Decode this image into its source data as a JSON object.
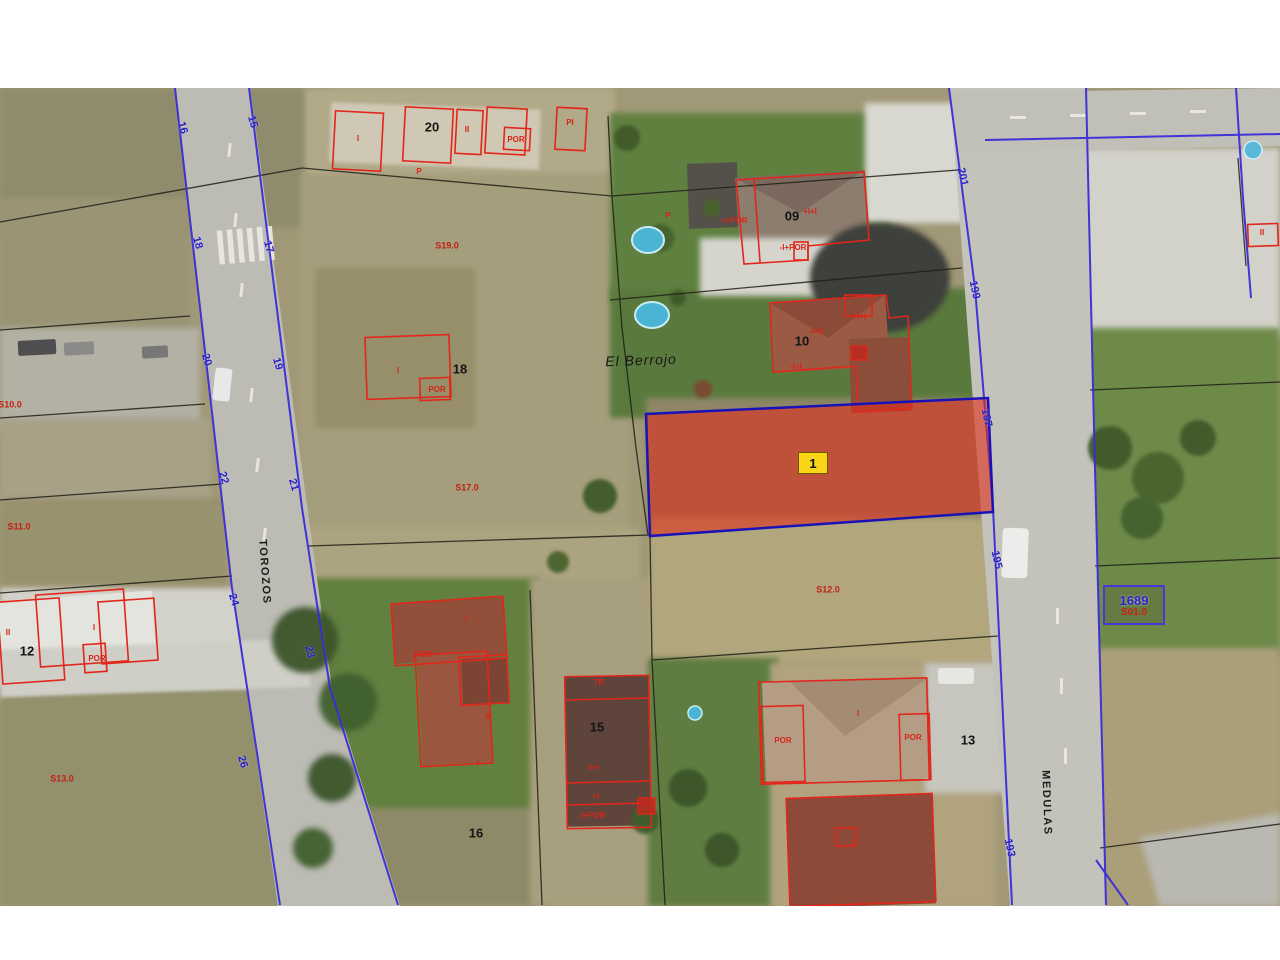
{
  "map": {
    "place_name": "El Berrojo",
    "highlight": {
      "label": "1"
    },
    "ref_box": {
      "id": "1689",
      "code": "S01.0"
    },
    "street_names": [
      "TOROZOS",
      "MEDULAS"
    ],
    "colors": {
      "building_outline_red": "#e2261b",
      "road_boundary_blue": "#3a2cd8",
      "parcel_boundary_black": "#1f1f18",
      "highlight_fill": "#e02e1c",
      "highlight_border": "#1812b8",
      "highlight_tag_yellow": "#f8d517",
      "street_number_blue": "#2a22c8",
      "ref_box_blue": "#4b36d8"
    },
    "labels": [
      {
        "t": "16",
        "x": 182,
        "y": 40,
        "r": 74,
        "cls": "nb"
      },
      {
        "t": "15",
        "x": 252,
        "y": 34,
        "r": 74,
        "cls": "nb"
      },
      {
        "t": "18",
        "x": 197,
        "y": 155,
        "r": 74,
        "cls": "nb"
      },
      {
        "t": "17",
        "x": 268,
        "y": 159,
        "r": 74,
        "cls": "nb"
      },
      {
        "t": "20",
        "x": 206,
        "y": 272,
        "r": 74,
        "cls": "nb"
      },
      {
        "t": "19",
        "x": 277,
        "y": 276,
        "r": 74,
        "cls": "nb"
      },
      {
        "t": "22",
        "x": 223,
        "y": 390,
        "r": 74,
        "cls": "nb"
      },
      {
        "t": "21",
        "x": 293,
        "y": 397,
        "r": 74,
        "cls": "nb"
      },
      {
        "t": "24",
        "x": 233,
        "y": 512,
        "r": 74,
        "cls": "nb"
      },
      {
        "t": "23",
        "x": 309,
        "y": 564,
        "r": 74,
        "cls": "nb"
      },
      {
        "t": "26",
        "x": 242,
        "y": 674,
        "r": 74,
        "cls": "nb"
      },
      {
        "t": "201",
        "x": 962,
        "y": 89,
        "r": 78,
        "cls": "nb"
      },
      {
        "t": "199",
        "x": 974,
        "y": 202,
        "r": 78,
        "cls": "nb"
      },
      {
        "t": "197",
        "x": 986,
        "y": 330,
        "r": 78,
        "cls": "nb"
      },
      {
        "t": "195",
        "x": 996,
        "y": 472,
        "r": 78,
        "cls": "nb"
      },
      {
        "t": "193",
        "x": 1009,
        "y": 760,
        "r": 78,
        "cls": "nb"
      },
      {
        "t": "20",
        "x": 432,
        "y": 39,
        "r": 0,
        "cls": "npk"
      },
      {
        "t": "09",
        "x": 792,
        "y": 128,
        "r": 0,
        "cls": "npk"
      },
      {
        "t": "10",
        "x": 802,
        "y": 253,
        "r": 0,
        "cls": "npk"
      },
      {
        "t": "18",
        "x": 460,
        "y": 281,
        "r": 0,
        "cls": "npk"
      },
      {
        "t": "12",
        "x": 27,
        "y": 563,
        "r": 0,
        "cls": "npk"
      },
      {
        "t": "15",
        "x": 597,
        "y": 639,
        "r": 0,
        "cls": "npk"
      },
      {
        "t": "16",
        "x": 476,
        "y": 745,
        "r": 0,
        "cls": "npk"
      },
      {
        "t": "13",
        "x": 968,
        "y": 652,
        "r": 0,
        "cls": "npk"
      },
      {
        "t": "S19.0",
        "x": 447,
        "y": 158,
        "r": 0,
        "cls": "cr"
      },
      {
        "t": "S17.0",
        "x": 467,
        "y": 400,
        "r": 0,
        "cls": "cr"
      },
      {
        "t": "S10.0",
        "x": 10,
        "y": 317,
        "r": 0,
        "cls": "cr"
      },
      {
        "t": "S11.0",
        "x": 19,
        "y": 439,
        "r": 0,
        "cls": "cr"
      },
      {
        "t": "S13.0",
        "x": 62,
        "y": 691,
        "r": 0,
        "cls": "cr"
      },
      {
        "t": "S12.0",
        "x": 828,
        "y": 502,
        "r": 0,
        "cls": "cr"
      },
      {
        "t": "I",
        "x": 358,
        "y": 51,
        "r": 0,
        "cls": "br"
      },
      {
        "t": "II",
        "x": 467,
        "y": 42,
        "r": 0,
        "cls": "br"
      },
      {
        "t": "POR",
        "x": 516,
        "y": 52,
        "r": 0,
        "cls": "br"
      },
      {
        "t": "PI",
        "x": 570,
        "y": 35,
        "r": 0,
        "cls": "br"
      },
      {
        "t": "P",
        "x": 419,
        "y": 84,
        "r": 0,
        "cls": "br"
      },
      {
        "t": "P",
        "x": 668,
        "y": 128,
        "r": 0,
        "cls": "br"
      },
      {
        "t": "-I+POR",
        "x": 734,
        "y": 133,
        "r": 0,
        "cls": "br"
      },
      {
        "t": "+I+I",
        "x": 810,
        "y": 124,
        "r": 0,
        "cls": "br"
      },
      {
        "t": "-I+POR",
        "x": 793,
        "y": 160,
        "r": 0,
        "cls": "br"
      },
      {
        "t": "-I+II",
        "x": 816,
        "y": 244,
        "r": 0,
        "cls": "br"
      },
      {
        "t": "+I+I",
        "x": 859,
        "y": 229,
        "r": 0,
        "cls": "br"
      },
      {
        "t": "-I+I",
        "x": 796,
        "y": 279,
        "r": 0,
        "cls": "br"
      },
      {
        "t": "I",
        "x": 398,
        "y": 283,
        "r": 0,
        "cls": "br"
      },
      {
        "t": "POR",
        "x": 437,
        "y": 302,
        "r": 0,
        "cls": "br"
      },
      {
        "t": "II",
        "x": 8,
        "y": 545,
        "r": 0,
        "cls": "br"
      },
      {
        "t": "I",
        "x": 94,
        "y": 540,
        "r": 0,
        "cls": "br"
      },
      {
        "t": "POR",
        "x": 97,
        "y": 571,
        "r": 0,
        "cls": "br"
      },
      {
        "t": "POR",
        "x": 423,
        "y": 567,
        "r": 0,
        "cls": "br"
      },
      {
        "t": "I",
        "x": 466,
        "y": 531,
        "r": 0,
        "cls": "br"
      },
      {
        "t": "II",
        "x": 488,
        "y": 629,
        "r": 0,
        "cls": "br"
      },
      {
        "t": "I",
        "x": 478,
        "y": 675,
        "r": 0,
        "cls": "br"
      },
      {
        "t": "TR",
        "x": 599,
        "y": 595,
        "r": 0,
        "cls": "br"
      },
      {
        "t": "-I+I",
        "x": 593,
        "y": 680,
        "r": 0,
        "cls": "br"
      },
      {
        "t": "+I",
        "x": 596,
        "y": 709,
        "r": 0,
        "cls": "br"
      },
      {
        "t": "-I+POR",
        "x": 592,
        "y": 728,
        "r": 0,
        "cls": "br"
      },
      {
        "t": "POR",
        "x": 783,
        "y": 653,
        "r": 0,
        "cls": "br"
      },
      {
        "t": "I",
        "x": 858,
        "y": 626,
        "r": 0,
        "cls": "br"
      },
      {
        "t": "POR",
        "x": 913,
        "y": 650,
        "r": 0,
        "cls": "br"
      },
      {
        "t": "I",
        "x": 853,
        "y": 757,
        "r": 0,
        "cls": "br"
      },
      {
        "t": "II",
        "x": 1262,
        "y": 145,
        "r": 0,
        "cls": "br"
      },
      {
        "t": "TOROZOS",
        "x": 264,
        "y": 484,
        "r": 86,
        "cls": "st"
      },
      {
        "t": "MEDULAS",
        "x": 1046,
        "y": 715,
        "r": 88,
        "cls": "st"
      },
      {
        "t": "El Berrojo",
        "x": 641,
        "y": 272,
        "r": -2,
        "cls": "pl"
      }
    ]
  }
}
